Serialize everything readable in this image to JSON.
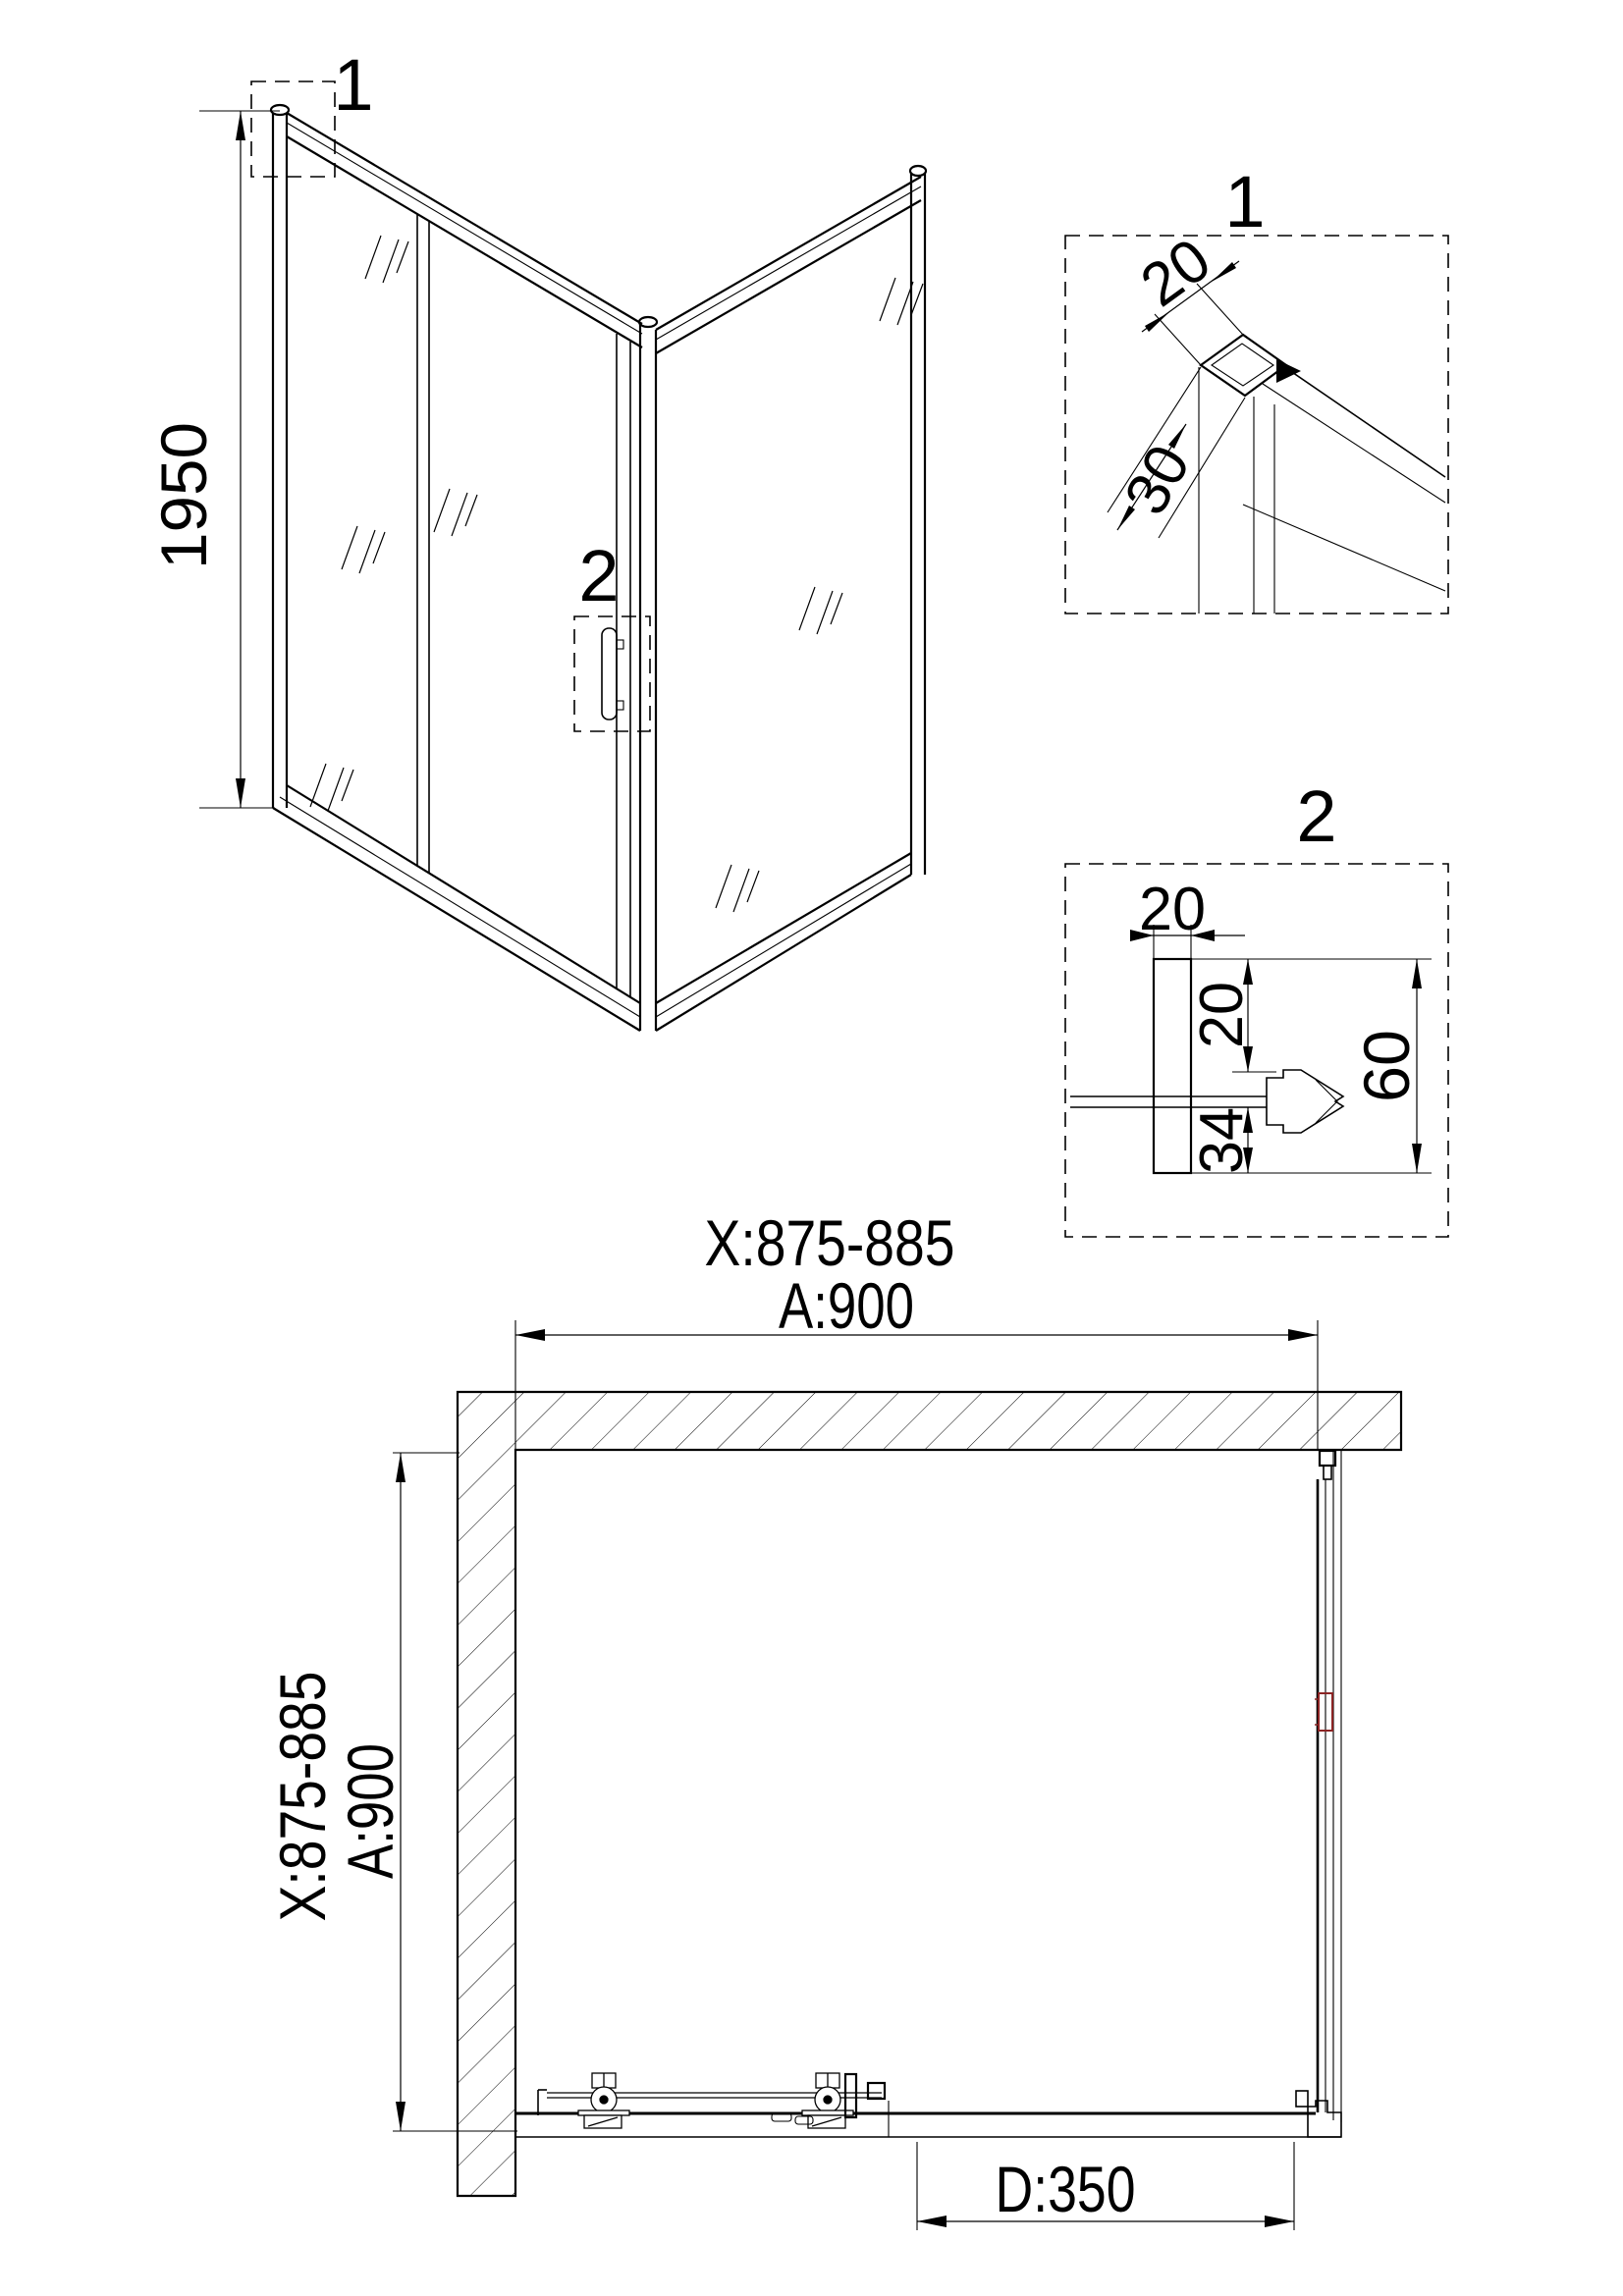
{
  "colors": {
    "background": "#ffffff",
    "ink": "#000000",
    "accent_red": "#8b2424"
  },
  "perspective": {
    "height_dim": "1950",
    "callout_frame": "1",
    "callout_handle": "2"
  },
  "detail1": {
    "label": "1",
    "dim_profile_width": "20",
    "dim_profile_depth": "30"
  },
  "detail2": {
    "label": "2",
    "dim_profile_width": "20",
    "dim_upper": "20",
    "dim_lower": "34",
    "dim_total": "60"
  },
  "plan": {
    "dim_width_range": "X:875-885",
    "dim_width": "A:900",
    "dim_depth_range": "X:875-885",
    "dim_depth": "A:900",
    "dim_door": "D:350"
  }
}
